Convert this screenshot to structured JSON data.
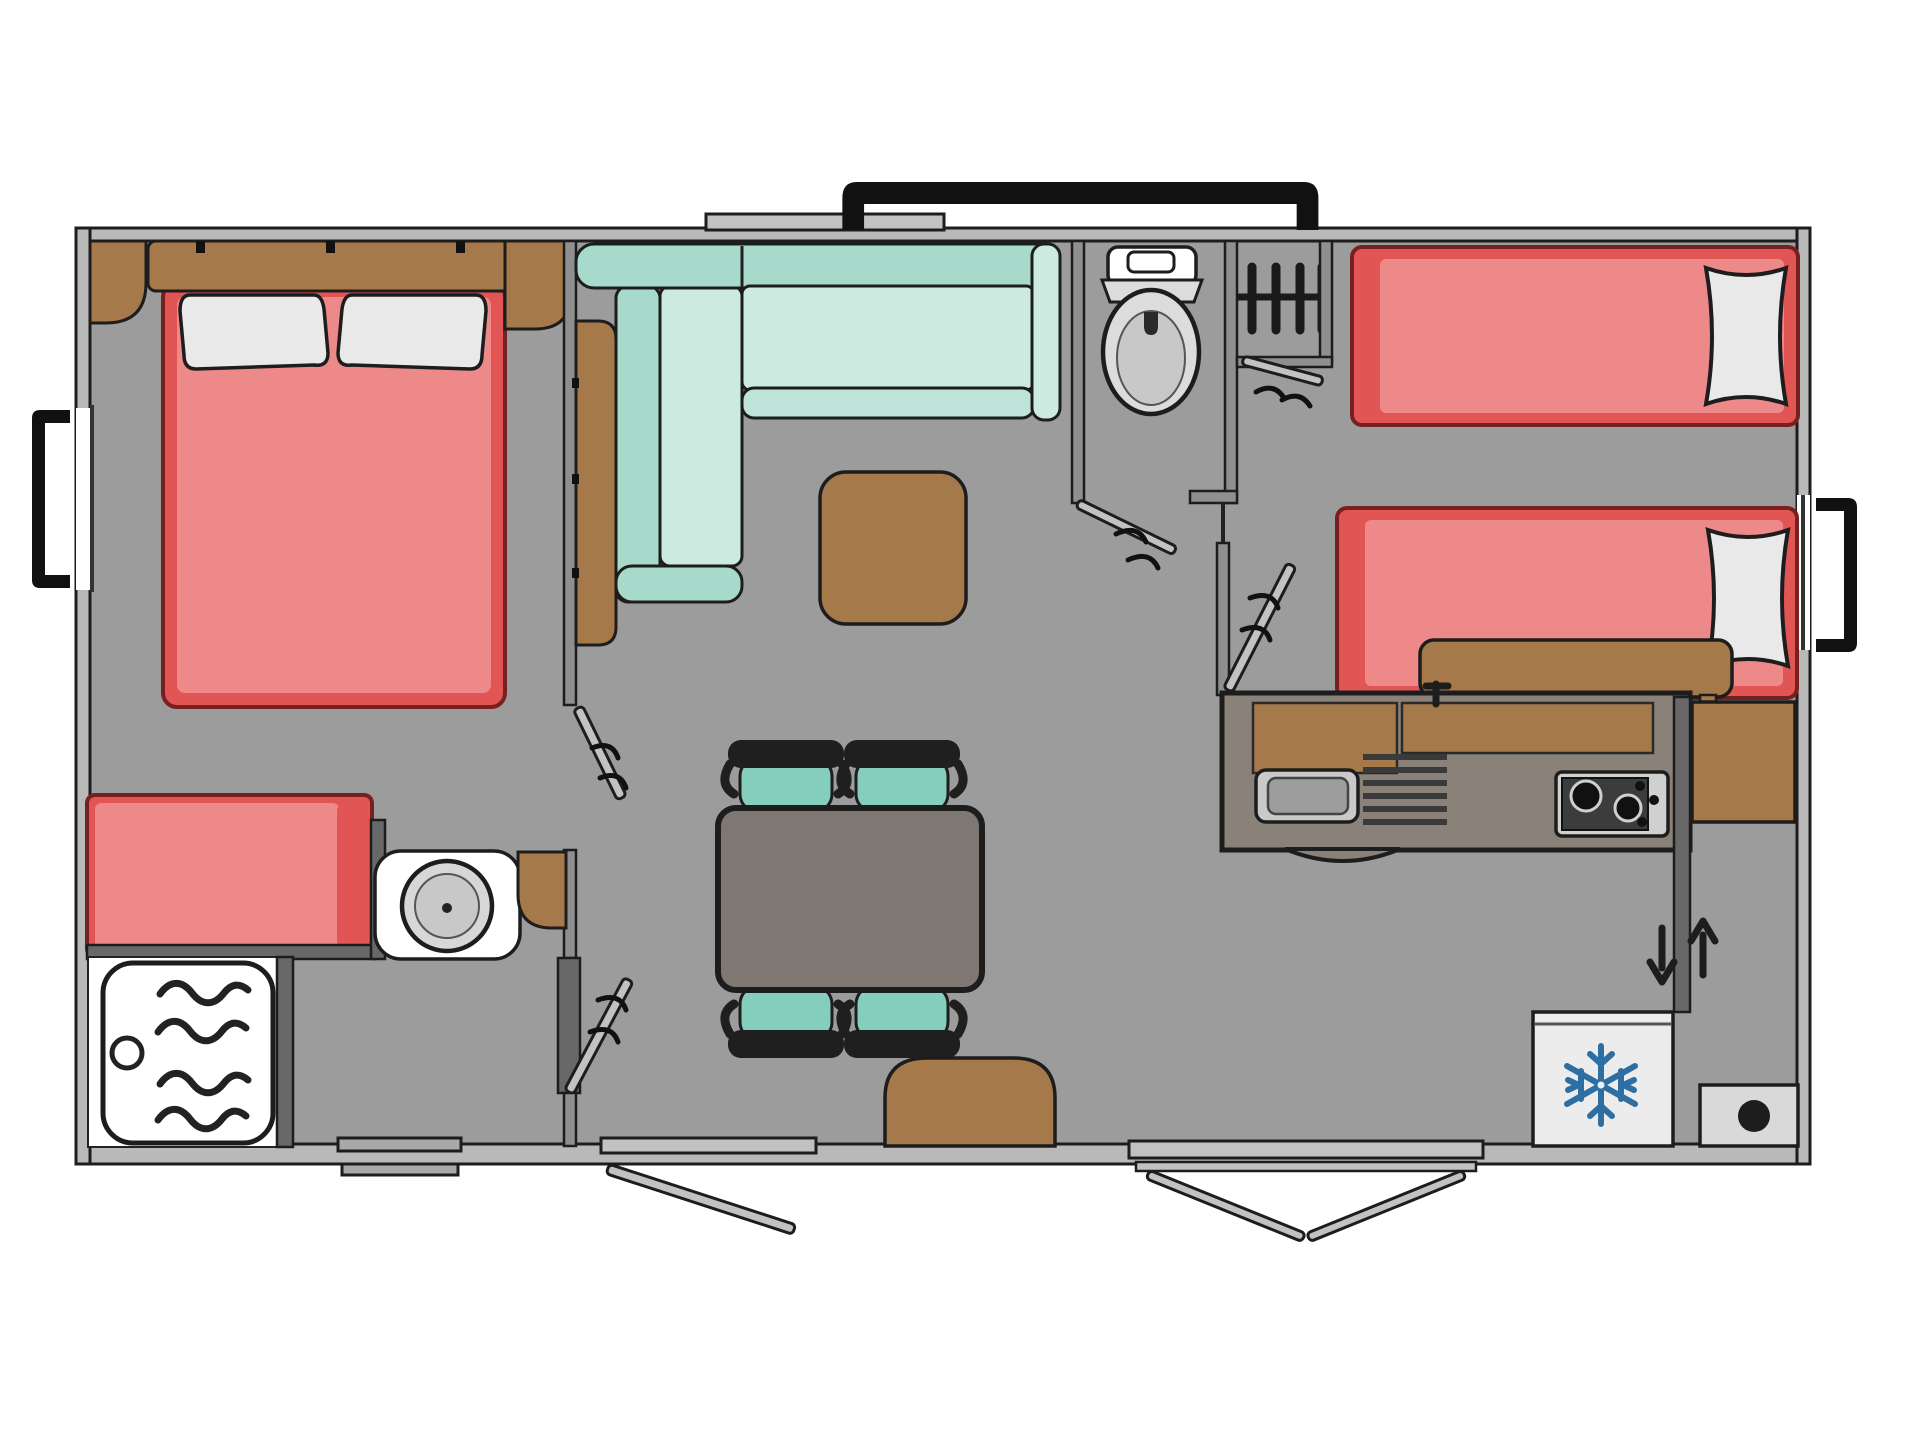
{
  "diagram": {
    "kind": "floor-plan",
    "palette": {
      "paper": "#ffffff",
      "floor": "#9c9c9c",
      "wall": "#b9b9b9",
      "wallMid": "#8f8f8f",
      "wallDark": "#686868",
      "outline": "#1d1d1d",
      "mattress": "#ee8989",
      "mattressEdge": "#e25555",
      "bedOutline": "#7a1f1f",
      "wood": "#a6794b",
      "woodDark": "#7c5a36",
      "sofaBack": "#a8dacc",
      "sofaSeat": "#cdeae1",
      "chairTeal": "#85cdbd",
      "table": "#7e7772",
      "counter": "#8a8178",
      "steel": "#c9c9c9",
      "steelWell": "#9d9d9d",
      "applianceDark": "#3c3c3c",
      "applianceLight": "#d0d0d0",
      "fridge": "#ececec",
      "snowflake": "#2e6fa3",
      "pillow": "#e9e9e9",
      "porcelain": "#ffffff",
      "seatGray": "#dcdcdc",
      "bowlGray": "#c8c8c8",
      "threshold": "#c2c2c2",
      "boilerBox": "#d9d9d9"
    },
    "rooms": [
      {
        "id": "master-bedroom",
        "label": "master bedroom"
      },
      {
        "id": "washroom",
        "label": "washroom with shower"
      },
      {
        "id": "living-room",
        "label": "living room"
      },
      {
        "id": "dining-area",
        "label": "dining area"
      },
      {
        "id": "wc",
        "label": "toilet room"
      },
      {
        "id": "twin-bedroom",
        "label": "twin bedroom"
      },
      {
        "id": "kitchen",
        "label": "kitchen"
      },
      {
        "id": "entrance",
        "label": "entrance"
      }
    ],
    "furniture": [
      "double-bed",
      "headboard",
      "pillows",
      "corner-cabinet",
      "nightstand",
      "single-bed",
      "washbasin",
      "corner-shelf",
      "shower-tray",
      "l-shaped-sofa",
      "tall-cabinet",
      "coffee-pouf",
      "dining-table",
      "dining-chairs",
      "floor-pouf",
      "toilet",
      "radiator",
      "cupboard",
      "twin-bed-1",
      "twin-bed-2",
      "storage-bench",
      "kitchen-counter",
      "sink",
      "drainer",
      "hob",
      "fridge",
      "wardrobe",
      "water-heater"
    ],
    "openings": [
      "skylight-top",
      "window-left",
      "window-right",
      "window-bottom",
      "living-room-door",
      "main-entrance-double-door",
      "wc-door",
      "master-bedroom-door",
      "washroom-door",
      "twin-bedroom-door",
      "cupboard-door"
    ]
  }
}
